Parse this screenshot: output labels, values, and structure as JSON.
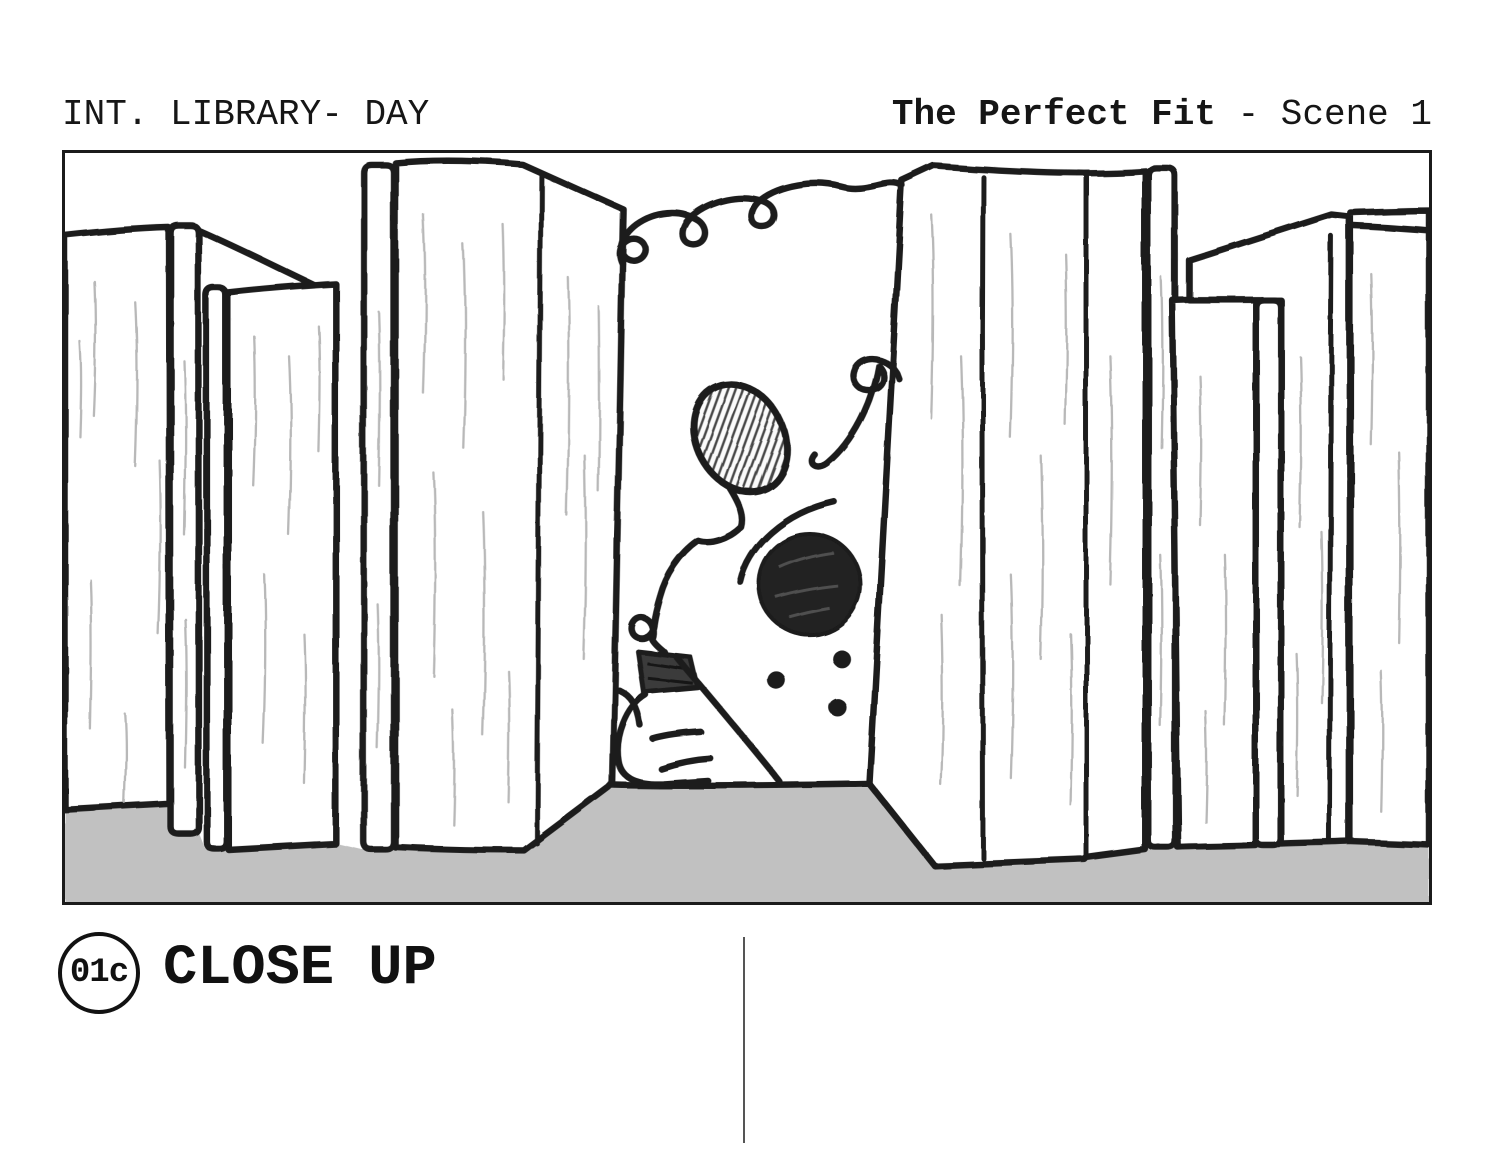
{
  "header": {
    "scene_heading": "INT. LIBRARY- DAY",
    "project_title": "The Perfect Fit",
    "scene_label": "- Scene 1"
  },
  "shot": {
    "number": "01c",
    "label": "CLOSE UP"
  },
  "colors": {
    "ink": "#1f1f1f",
    "paper": "#ffffff",
    "floor": "#c1c1c1",
    "hatch": "#b4b4b4",
    "divider": "#555555"
  }
}
